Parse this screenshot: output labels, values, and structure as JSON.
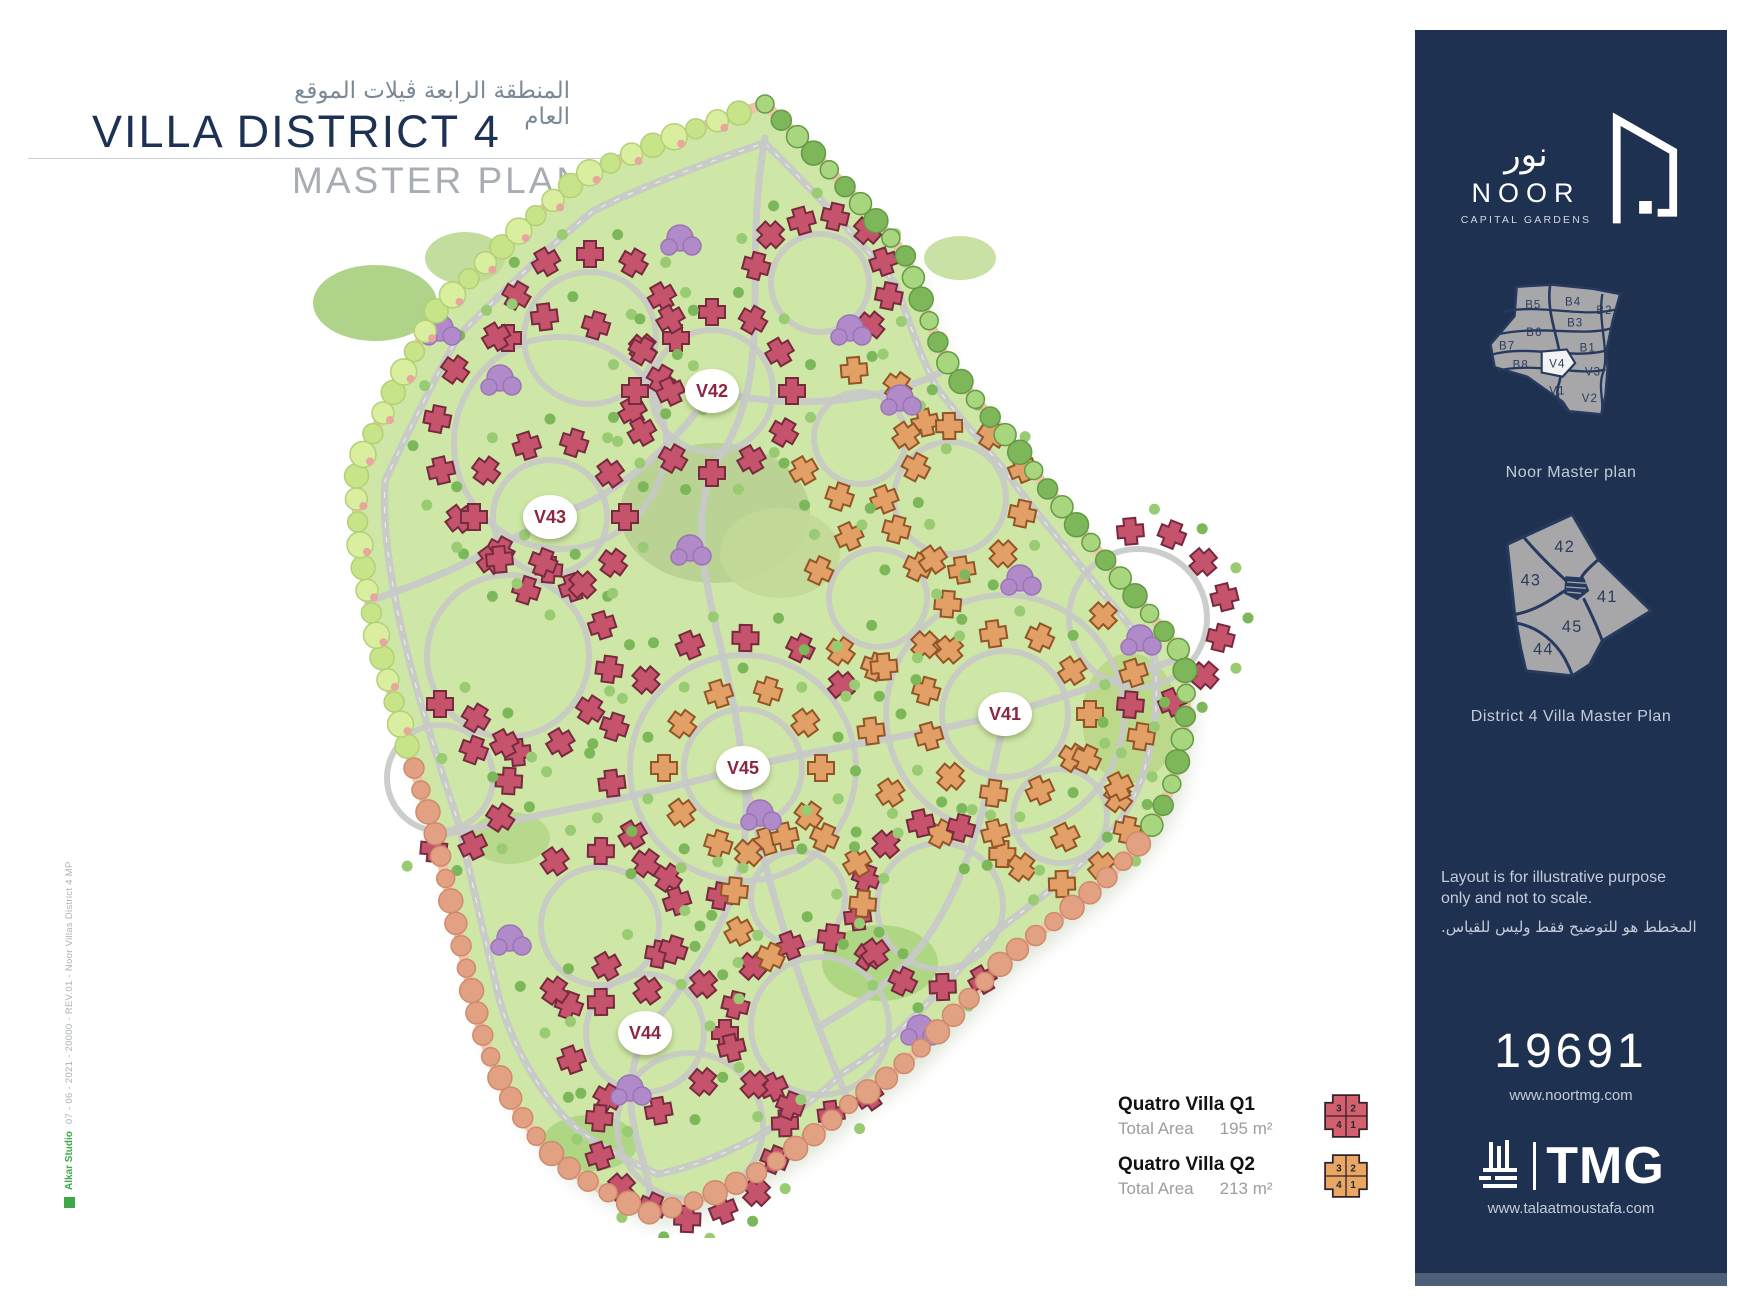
{
  "title": {
    "ar": "المنطقة الرابعة ڤيلات الموقع العام",
    "main": "VILLA DISTRICT 4",
    "sub": "MASTER PLAN"
  },
  "side_credit": {
    "studio": "Alkar Studio",
    "note": "07 - 06 - 2021 - 20000 - REV.01 - Noor Villas District 4 MP"
  },
  "map": {
    "zones": [
      {
        "label": "V42"
      },
      {
        "label": "V43"
      },
      {
        "label": "V41"
      },
      {
        "label": "V45"
      },
      {
        "label": "V44"
      }
    ]
  },
  "legend": {
    "items": [
      {
        "name": "Quatro Villa Q1",
        "area_label": "Total Area",
        "area_value": "195 m²",
        "color": "#d4606e",
        "outline": "#33222c",
        "quadrants": [
          "3",
          "2",
          "4",
          "1"
        ]
      },
      {
        "name": "Quatro Villa Q2",
        "area_label": "Total Area",
        "area_value": "213 m²",
        "color": "#eaa763",
        "outline": "#33222c",
        "quadrants": [
          "3",
          "2",
          "4",
          "1"
        ]
      }
    ]
  },
  "sidebar": {
    "logo": {
      "ar": "نور",
      "name": "NOOR",
      "tagline": "CAPITAL GARDENS"
    },
    "master_plan": {
      "caption": "Noor Master plan",
      "zones": [
        "B5",
        "B4",
        "B2",
        "B3",
        "B6",
        "B7",
        "B1",
        "B8",
        "V4",
        "V3",
        "V1",
        "V2"
      ],
      "highlighted": "V4"
    },
    "district_plan": {
      "caption": "District 4 Villa Master Plan",
      "zones": [
        "42",
        "43",
        "41",
        "45",
        "44"
      ]
    },
    "disclaimer": {
      "en1": "Layout is for illustrative purpose",
      "en2": "only and not to scale.",
      "ar": "المخطط هو للتوضيح فقط وليس للقياس."
    },
    "project_number": "19691",
    "website": "www.noortmg.com",
    "tmg": {
      "name": "TMG",
      "website": "www.talaatmoustafa.com"
    }
  },
  "colors": {
    "sidebar_bg": "#1f3150",
    "map_green": "#cfe7a6",
    "villa_pink": "#c6536c",
    "villa_orange": "#e2a067",
    "zone_label_text": "#8c2640",
    "perimeter_salmon": "#e3a184"
  }
}
